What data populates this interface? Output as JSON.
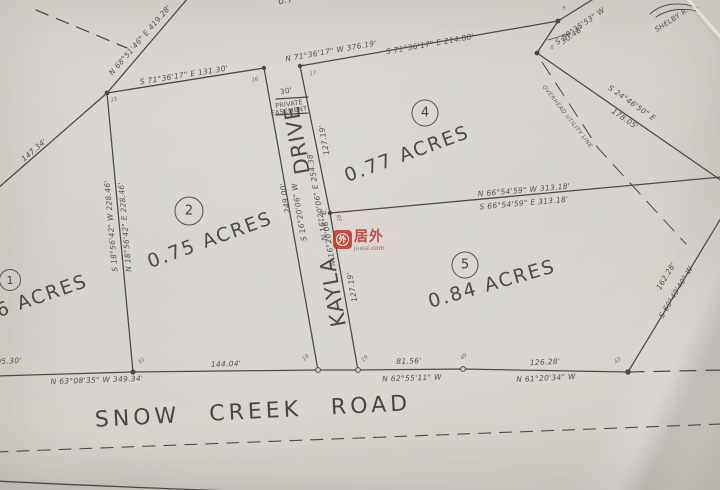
{
  "watermark": {
    "brand_cn": "居外",
    "site_name": "Juwai",
    "site_tld": ".com",
    "logo_glyph": "外",
    "brand_color": "#c5362b"
  },
  "road_name": "SNOW CREEK ROAD",
  "street": {
    "name_top": "DRIVE",
    "name_bottom": "KAYLA",
    "width": "30'",
    "easement_top": "PRIVATE",
    "easement_bottom": "EASEMENT"
  },
  "lots": {
    "lot1": {
      "number": "1",
      "acreage": "6 ACRES"
    },
    "lot2": {
      "number": "2",
      "acreage": "0.75 ACRES"
    },
    "lot4": {
      "number": "4",
      "acreage": "0.77 ACRES"
    },
    "lot5": {
      "number": "5",
      "acreage": "0.84 ACRES"
    }
  },
  "bearings": {
    "nw_diagonal": "N 68°51'46\" E   419.28'",
    "west_segment": "147.34'",
    "lot2_north": "S 71°36'17\" E   131.30'",
    "lot4_north_w": "N 71°36'17\" W   376.19'",
    "lot4_north_e": "S 71°36'17\" E   214.88'",
    "ne_tie_bearing": "S 59°35'53\" W",
    "ne_tie_dist": "30.48'",
    "east_diag_bearing": "S 24°46'50\" E",
    "east_diag_dist": "178.05'",
    "divider_n": "N 66°54'59\" W   313.18'",
    "divider_s": "S 66°54'59\" E   313.18'",
    "lot2_west_1": "S 18°56'42\" W   228.46'",
    "lot2_west_2": "N 18°56'42\" E   228.46'",
    "drive_west_dist": "249.00'",
    "drive_west_bearing": "S 16°20'06\" W",
    "drive_east": "N 16°20'06\" E   254.38'",
    "drive_east_lower": "N 16°20'06\" E",
    "lot4_west_dist": "127.19'",
    "lot5_west_dist": "127.19'",
    "road_left_partial": "05.30'",
    "road_seg1": "N 63°08'35\" W   349.34'",
    "road_seg1_dist2": "144.04'",
    "road_seg2_dist": "81.56'",
    "road_seg2": "N 62°55'11\" W",
    "road_seg3_dist": "126.28'",
    "road_seg3": "N 61°20'34\" W",
    "east_line_dist": "162.28'",
    "east_line_bearing": "S 60°49'40\" W"
  },
  "points": {
    "p5": "5",
    "p6": "6",
    "p15": "15",
    "p16": "16",
    "p17": "17",
    "p18": "18",
    "p18b": "18",
    "p19": "19",
    "p43": "43",
    "p49": "49",
    "p61": "61"
  },
  "notes": {
    "owner": "SHELBY R.",
    "utility_line": "OVERHEAD UTILITY LINE",
    "top_edge_partial": "0.7"
  }
}
